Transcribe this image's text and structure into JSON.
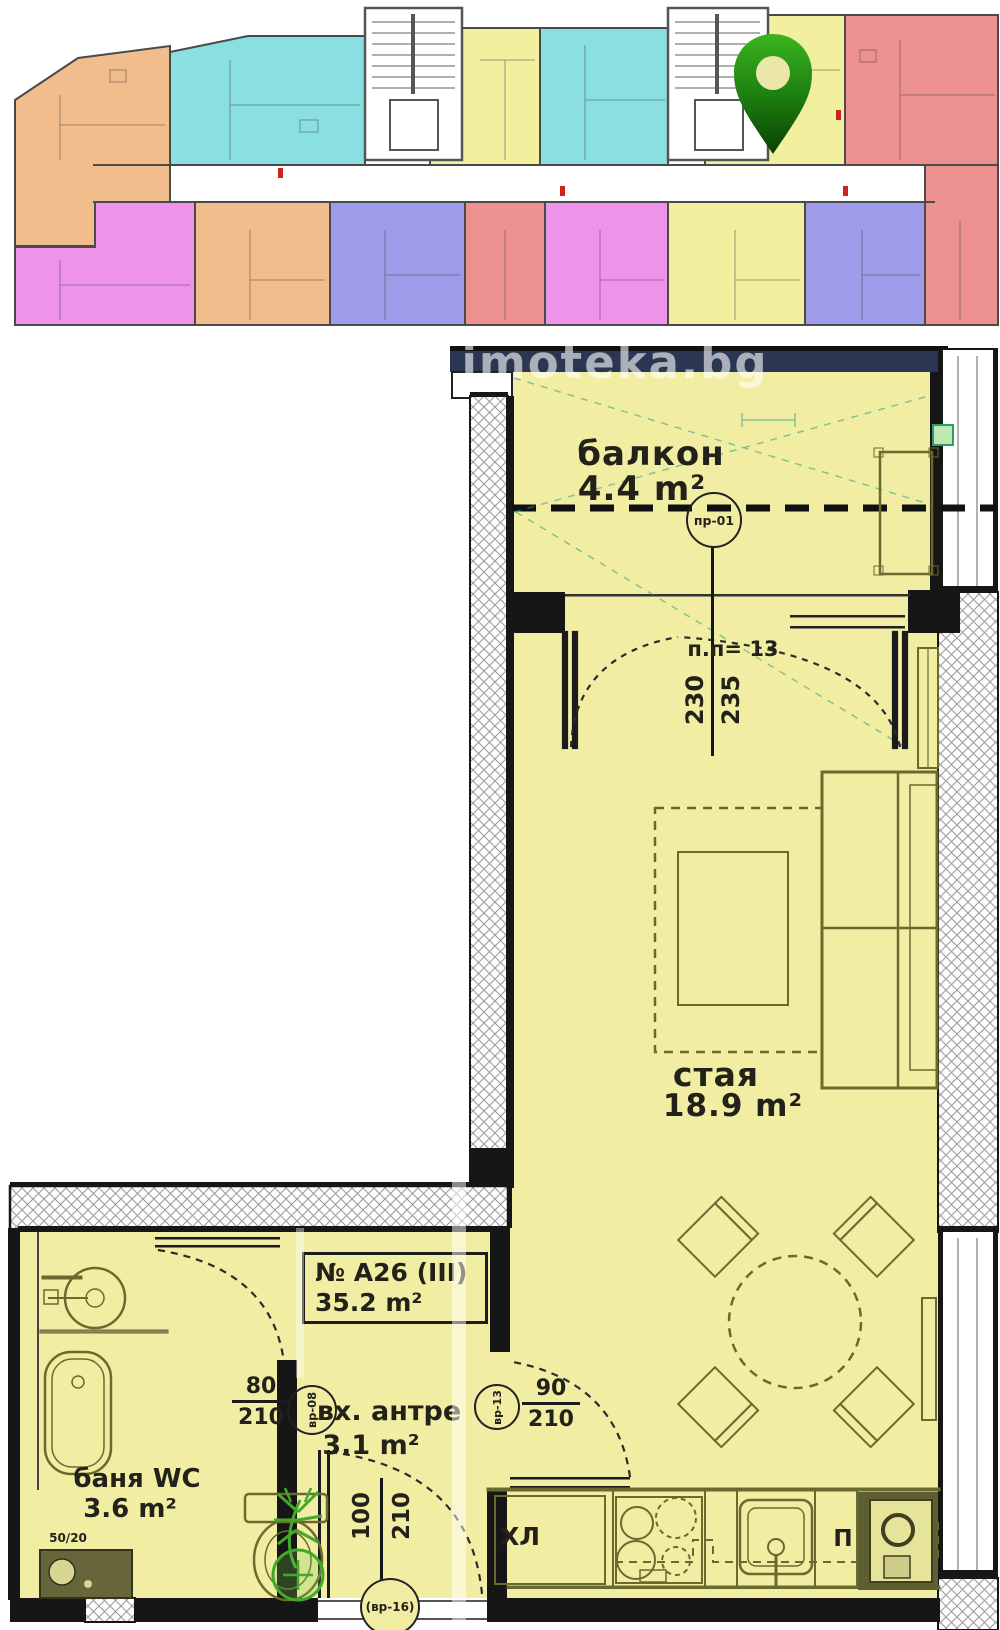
{
  "watermark": "imoteka.bg",
  "overview": {
    "marker": "location-pin",
    "unit_colors": {
      "orange": "#f2bd8d",
      "cyan": "#8ae0e0",
      "yellow": "#f2ef9e",
      "magenta": "#ee93ea",
      "purple": "#9e9ce8",
      "red": "#ed9090",
      "stairwell": "#ffffff",
      "walls": "#4a4a4a",
      "pin_green": "#1d8110"
    }
  },
  "plan": {
    "colors": {
      "floor": "#f1eea3",
      "wall": "#161616",
      "parapet_navy": "#2b3752",
      "furniture": "#6a6a2f",
      "plant_green": "#44a82a"
    },
    "balcony": {
      "label": "балкон",
      "area": "4.4 m²",
      "window_tag": "пр-01",
      "dims": {
        "width": "230",
        "height": "235"
      }
    },
    "room": {
      "label": "стая",
      "area": "18.9 m²",
      "note": "п.п= 13"
    },
    "apartment_box": {
      "number": "№ А26 (III)",
      "area": "35.2 m²"
    },
    "entry_hall": {
      "label": "вх. антре",
      "area": "3.1 m²"
    },
    "bathroom": {
      "label": "баня WC",
      "area": "3.6 m²",
      "vent": "50/20"
    },
    "doors": {
      "bathroom_door": {
        "width": "80",
        "height": "210",
        "tag": "вр-08"
      },
      "room_door": {
        "width": "90",
        "height": "210",
        "tag": "вр-13"
      },
      "entry_door": {
        "width": "100",
        "height": "210",
        "tag": "(вр-16)"
      }
    },
    "kitchen": {
      "fridge_label": "ХЛ",
      "pantry_label": "П"
    }
  }
}
